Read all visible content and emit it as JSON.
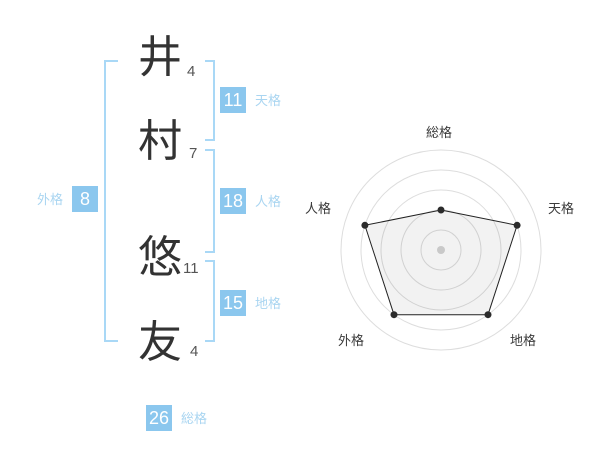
{
  "name_block": {
    "characters": [
      {
        "char": "井",
        "strokes": "4"
      },
      {
        "char": "村",
        "strokes": "7"
      },
      {
        "char": "悠",
        "strokes": "11"
      },
      {
        "char": "友",
        "strokes": "4"
      }
    ]
  },
  "kaku_badges": {
    "tenkaku": {
      "value": "11",
      "label": "天格"
    },
    "jinkaku": {
      "value": "18",
      "label": "人格"
    },
    "chikaku": {
      "value": "15",
      "label": "地格"
    },
    "gaikaku": {
      "value": "8",
      "label": "外格"
    },
    "soukaku": {
      "value": "26",
      "label": "総格"
    }
  },
  "colors": {
    "badge_bg": "#8BC7EE",
    "badge_text": "#FFFFFF",
    "kaku_label": "#A9D5F1",
    "bracket": "#A9D8F6",
    "kanji": "#333333",
    "stroke_count": "#555555",
    "radar_grid": "#DDDDDD",
    "radar_line": "#222222",
    "radar_point": "#2B2B2B",
    "radar_center_dot": "#C9C9C9",
    "radar_label": "#3A3A3A",
    "radar_fill": "rgba(0,0,0,0.05)"
  },
  "chart_data": {
    "type": "radar",
    "categories": [
      "総格",
      "天格",
      "地格",
      "外格",
      "人格"
    ],
    "values": [
      2,
      4,
      4,
      4,
      4
    ],
    "scale_max": 5,
    "rings": 5,
    "start_angle_deg": -90,
    "direction": "clockwise",
    "grid_shape": "circles",
    "legend": false,
    "title": ""
  }
}
